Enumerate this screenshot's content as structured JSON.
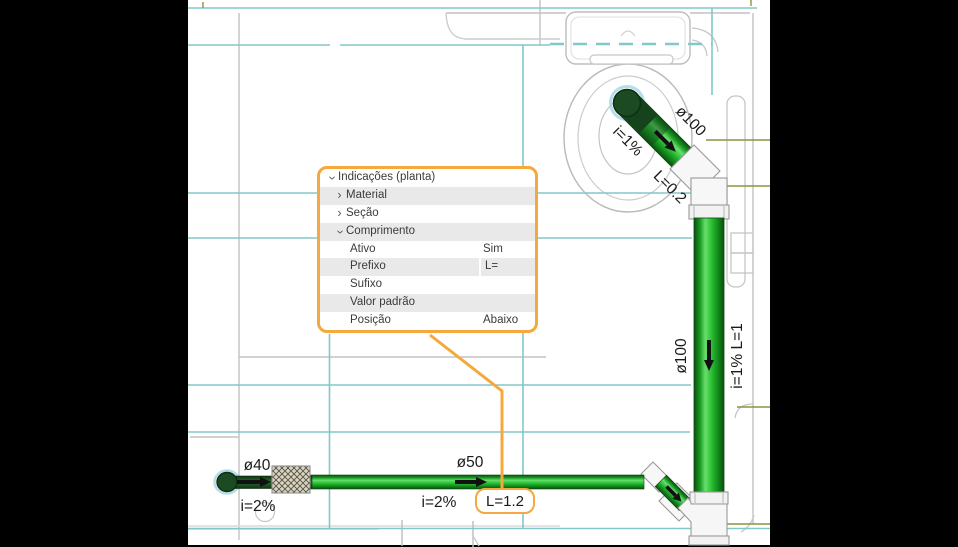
{
  "panel": {
    "title": "Indicações (planta)",
    "rows": [
      {
        "label": "Material",
        "value": "",
        "kind": "category",
        "state": "collapsed"
      },
      {
        "label": "Seção",
        "value": "",
        "kind": "category",
        "state": "collapsed"
      },
      {
        "label": "Comprimento",
        "value": "",
        "kind": "category",
        "state": "expanded"
      },
      {
        "label": "Ativo",
        "value": "Sim",
        "kind": "property"
      },
      {
        "label": "Prefixo",
        "value": "L=",
        "kind": "property"
      },
      {
        "label": "Sufixo",
        "value": "",
        "kind": "property"
      },
      {
        "label": "Valor padrão",
        "value": "",
        "kind": "property"
      },
      {
        "label": "Posição",
        "value": "Abaixo",
        "kind": "property"
      }
    ]
  },
  "callout": {
    "label": "L=1.2"
  },
  "labels": {
    "wc_branch_diameter": "ø100",
    "wc_branch_slope": "i=1%",
    "wc_branch_length": "L=0.2",
    "stack_diameter": "ø100",
    "stack_slope_length": "i=1%  L=1",
    "branch_diameter": "ø50",
    "branch_slope": "i=2%",
    "inlet_diameter": "ø40",
    "inlet_slope": "i=2%"
  },
  "icons": {
    "chevron_collapsed": "›",
    "chevron_expanded": "›"
  },
  "colors": {
    "accent_orange": "#F4A83D",
    "pipe_green_bright": "#2EC437",
    "pipe_green_dark": "#1C4A22",
    "guide_teal": "#82C7CA",
    "guide_olive": "#8A9340",
    "wall_gray": "#C2C2C2"
  }
}
